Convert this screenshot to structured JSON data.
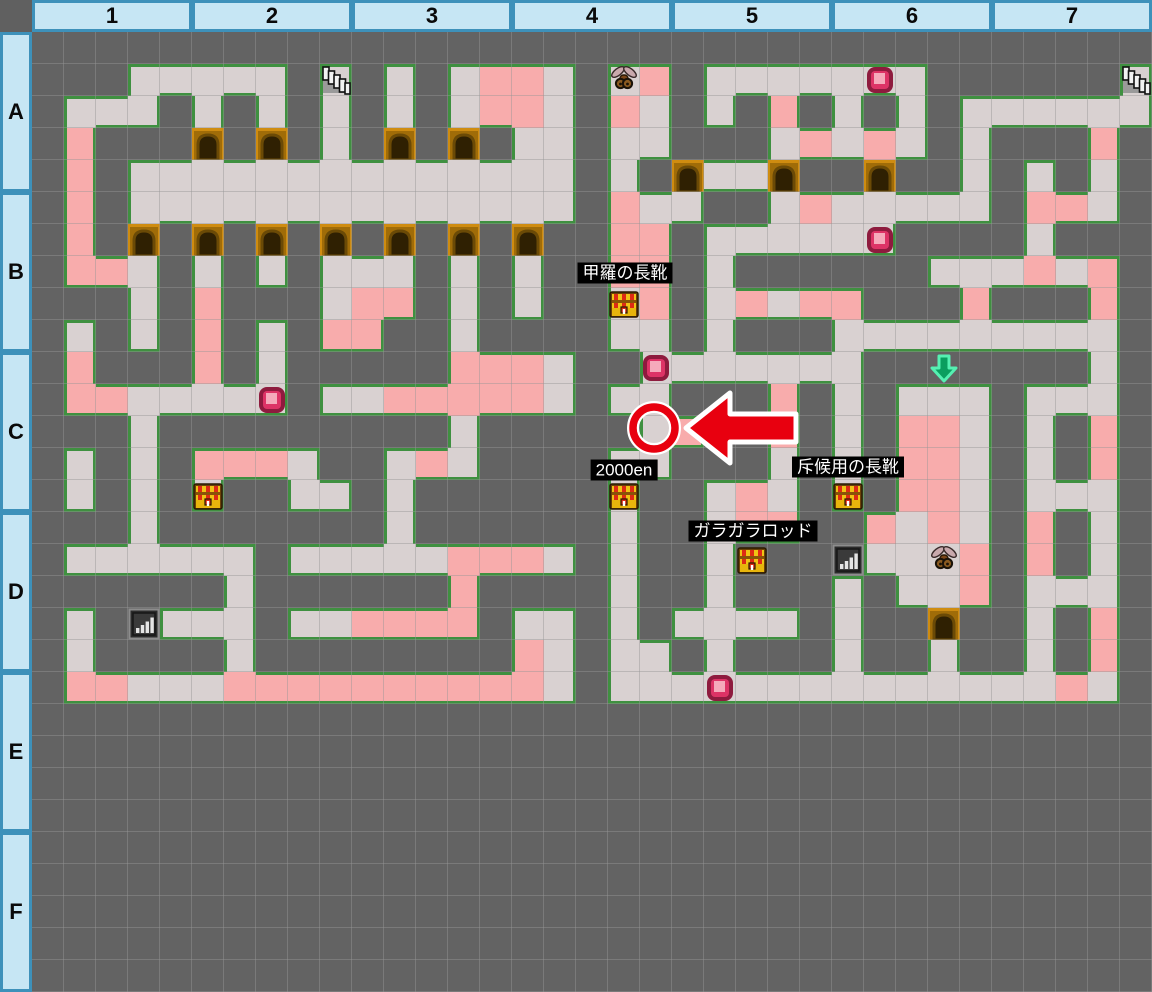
{
  "title": "dungeon-floor-map",
  "header": {
    "columns": [
      "1",
      "2",
      "3",
      "4",
      "5",
      "6",
      "7"
    ],
    "rows": [
      "A",
      "B",
      "C",
      "D",
      "E",
      "F"
    ]
  },
  "colors": {
    "background": "#636363",
    "floor": "#d9d1d1",
    "damage_floor": "#f8acac",
    "wall_outline": "#3f9040",
    "door": "#cf8c10",
    "header_bg": "#c6e6f4",
    "header_border": "#3d91ba",
    "label_bg": "#000000",
    "label_text": "#ffffff",
    "marker_red": "#e8000f",
    "gem_pink": "#dd3366",
    "arrow_green": "#0a9e5f"
  },
  "map": {
    "tile_size": 32,
    "origin_x": 32,
    "origin_y": 32,
    "cols": 35,
    "rows": 30,
    "legend": {
      ".": "unexplored",
      "f": "floor",
      "p": "damage-floor",
      "D": "door"
    },
    "grid": [
      "..... ..... ..... ..... ..... ..... .....",
      "...ff fff.f .f.fp pf.fp .ffff fff.. ....f",
      ".fff. f.f.f .f.fp pf.pf .f.p. f.f.f fffff",
      ".p... D.D.f .D.D. ff.ff ...fp fpf.f ...p.",
      ".p.ff fffff fffff ff.f. DffD. .D..f .f.f.",
      ".p.ff fffff fffff ff.pf f..fp fffff .ppf.",
      ".p.D. D.D.D .D.D. D..pp .ffff ff... .f...",
      ".ppf. f.f.f ff.f. f..pp .f... ...ff fpfp.",
      "...f. p...f pp.f. f..fp .fpfp p...p ...p.",
      ".f.f. p.f.p p..f. ...ff .f... fffff ffff.",
      ".p... p.f.. ...pp pf..f fffff f.... ...f.",
      ".ppff fff.f fpppp pf.ff ...p. f.fff .fff.",
      "...f. ..... ...f. ....f p..p. f.ppf .f.p.",
      ".f.f. pppf. .fpf. ...ff ...f. f.ppf .f.p.",
      ".f.f. f..ff .f... ...f. .fpf. f.ppf .fff.",
      "...f. ..... .f... ...f. .fpp. .pfpf .p.f.",
      ".ffff ff.ff fffpp pf.f. .f... .fffp .p.f.",
      "..... .f... ...p. ...f. .f... f.ffp .fff.",
      ".f..f ff.ff pppp. ff.f. ffff. f..D. .f.p.",
      ".f... .f... ..... pf.ff .f... f..f. .f.p.",
      ".ppff fpppp ppppp pf.ff fffff fffff ffpf.",
      "..... ..... ..... ..... ..... ..... .....",
      "..... ..... ..... ..... ..... ..... .....",
      "..... ..... ..... ..... ..... ..... .....",
      "..... ..... ..... ..... ..... ..... .....",
      "..... ..... ..... ..... ..... ..... .....",
      "..... ..... ..... ..... ..... ..... .....",
      "..... ..... ..... ..... ..... ..... .....",
      "..... ..... ..... ..... ..... ..... .....",
      "..... ..... ..... ..... ..... ..... ....."
    ]
  },
  "items": [
    {
      "type": "stairs",
      "col": 9,
      "row": 1
    },
    {
      "type": "stairs",
      "col": 34,
      "row": 1
    },
    {
      "type": "monster",
      "col": 18,
      "row": 1
    },
    {
      "type": "monster",
      "col": 28,
      "row": 16
    },
    {
      "type": "gem",
      "col": 26,
      "row": 1
    },
    {
      "type": "gem",
      "col": 26,
      "row": 6
    },
    {
      "type": "gem",
      "col": 19,
      "row": 10
    },
    {
      "type": "gem",
      "col": 7,
      "row": 11
    },
    {
      "type": "gem",
      "col": 21,
      "row": 20
    },
    {
      "type": "chest",
      "col": 18,
      "row": 8
    },
    {
      "type": "chest",
      "col": 5,
      "row": 14
    },
    {
      "type": "chest",
      "col": 18,
      "row": 14
    },
    {
      "type": "chest",
      "col": 25,
      "row": 14
    },
    {
      "type": "chest",
      "col": 22,
      "row": 16
    },
    {
      "type": "chart",
      "col": 3,
      "row": 18
    },
    {
      "type": "chart",
      "col": 25,
      "row": 16
    },
    {
      "type": "down-arrow",
      "col": 28,
      "row": 10
    }
  ],
  "labels": [
    {
      "text": "甲羅の長靴",
      "cx": 625,
      "cy": 273
    },
    {
      "text": "2000en",
      "cx": 624,
      "cy": 470
    },
    {
      "text": "斥候用の長靴",
      "cx": 848,
      "cy": 467
    },
    {
      "text": "ガラガラロッド",
      "cx": 753,
      "cy": 531
    }
  ],
  "marker": {
    "circle": {
      "cx": 654,
      "cy": 428,
      "r": 21
    },
    "arrow": {
      "x": 678,
      "y": 386,
      "width": 124,
      "height": 84
    }
  }
}
